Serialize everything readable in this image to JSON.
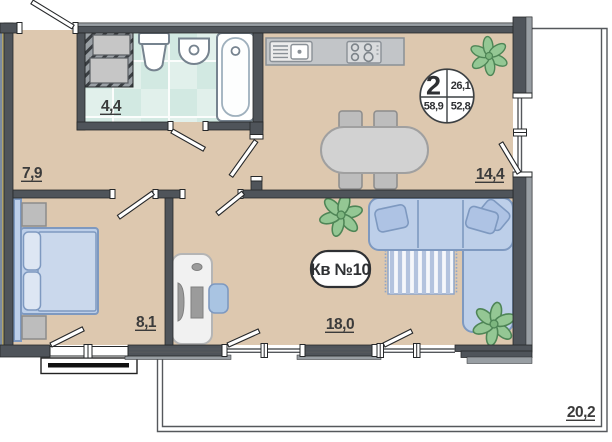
{
  "apartment": {
    "label": "Кв №10",
    "badge": {
      "rooms_count": "2",
      "living_area": "26,1",
      "total_area_with_balcony": "58,9",
      "total_area": "52,8"
    }
  },
  "areas": {
    "hallway": "7,9",
    "bathroom": "4,4",
    "bedroom": "8,1",
    "living_room": "18,0",
    "kitchen": "14,4",
    "terrace": "20,2"
  },
  "icons": [
    "bathtub-icon",
    "toilet-icon",
    "sink-icon",
    "vent-shaft-icon",
    "kitchen-sink-icon",
    "stove-icon",
    "dining-table-icon",
    "chair-icon",
    "bed-icon",
    "nightstand-icon",
    "desk-icon",
    "office-chair-icon",
    "sofa-icon",
    "rug-icon",
    "plant-icon",
    "door-leaf-icon",
    "window-icon",
    "balcony-icon"
  ],
  "colors": {
    "wall": "#4f545a",
    "floor": "#ddc8af",
    "tile_light": "#e1f0eb",
    "tile_dark": "#d2e9e2",
    "furniture_blue": "#bdcfe9",
    "furniture_stroke": "#7e99c0",
    "plant_green": "#94c794",
    "plant_stroke": "#4e8556",
    "label_text": "#3b3b3b"
  }
}
